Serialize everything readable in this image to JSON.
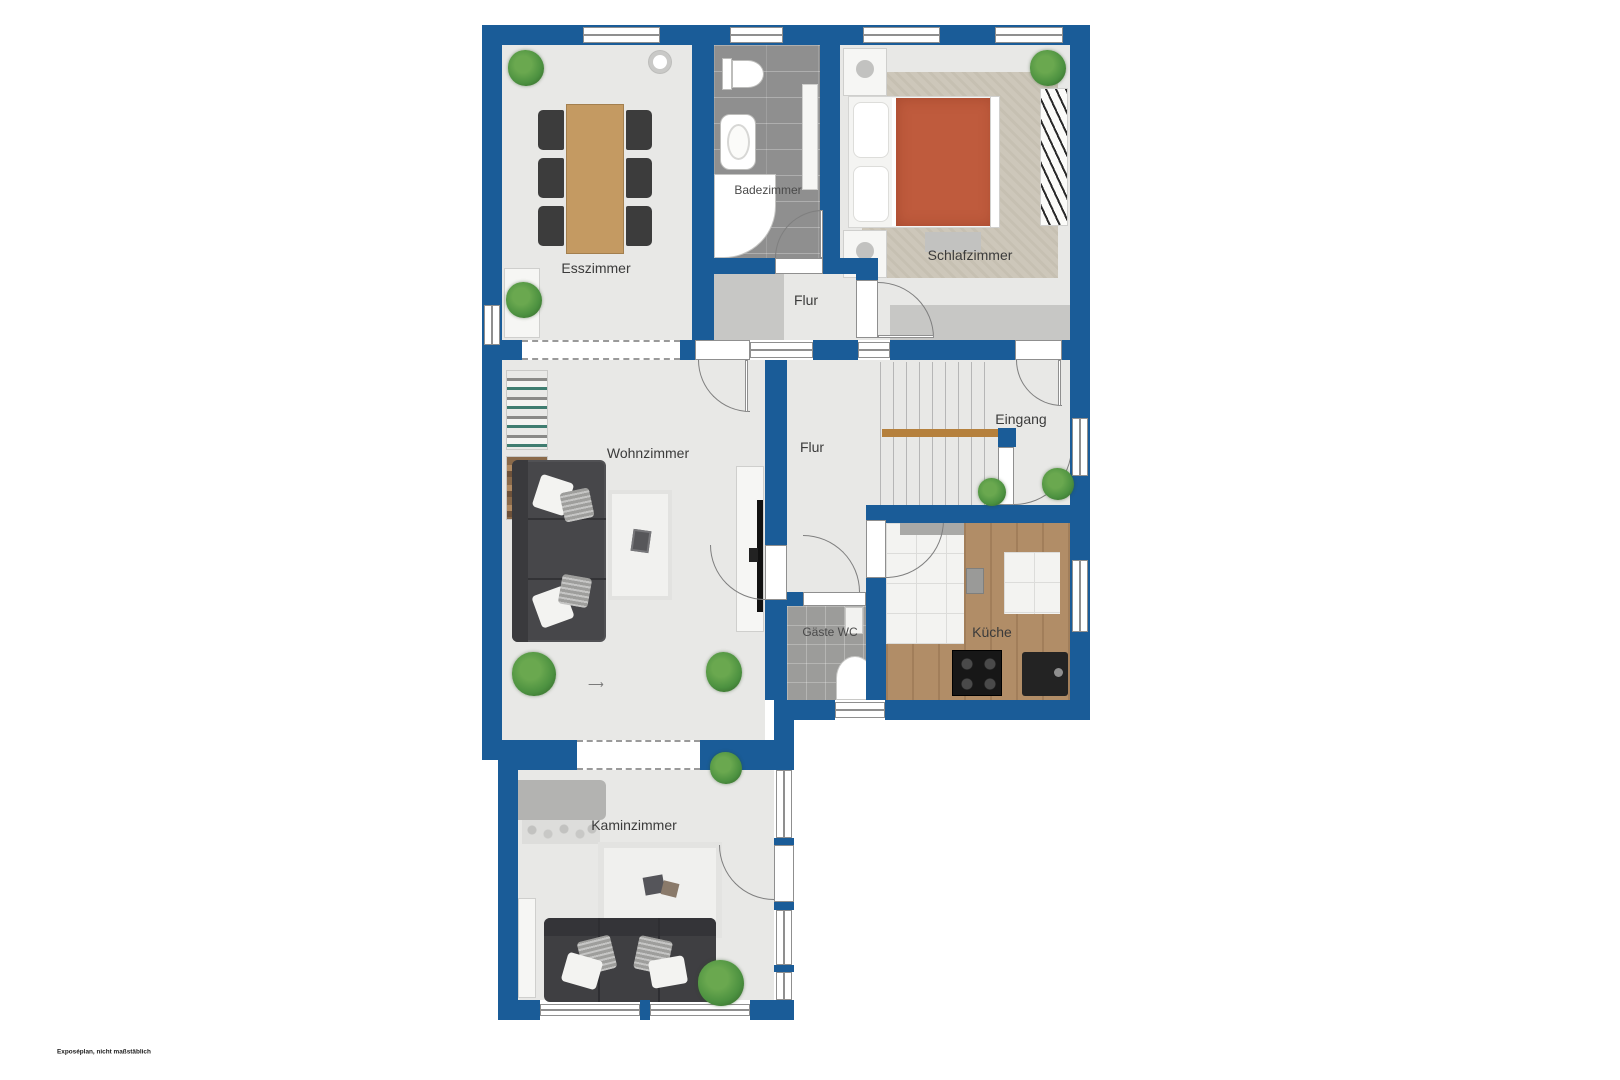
{
  "plan": {
    "disclaimer": "Exposéplan, nicht maßstäblich",
    "rooms": {
      "esszimmer": {
        "label": "Esszimmer"
      },
      "badezimmer": {
        "label": "Badezimmer"
      },
      "schlafzimmer": {
        "label": "Schlafzimmer"
      },
      "flur_oben": {
        "label": "Flur"
      },
      "flur_mitte": {
        "label": "Flur"
      },
      "eingang": {
        "label": "Eingang"
      },
      "wohnzimmer": {
        "label": "Wohnzimmer"
      },
      "gaeste_wc": {
        "label": "Gäste WC"
      },
      "kueche": {
        "label": "Küche"
      },
      "kaminzimmer": {
        "label": "Kaminzimmer"
      }
    },
    "colors": {
      "wall": "#1a5c98",
      "floor": "#e8e8e6",
      "bath_tile": "#8f8f8f",
      "wc_tile": "#9c9c9a",
      "kitchen_tile": "#f3f3f1",
      "counter_wood": "#b18d67",
      "table_wood": "#c49a62",
      "sofa_dark": "#47474a",
      "bed_blanket": "#bf5b3d",
      "bedroom_rug": "#cdc7ba",
      "plant_green": "#4c9140",
      "handrail_wood": "#b5803c",
      "closet_gray": "#c7c7c5",
      "fireplace_gray": "#b3b3b1",
      "label_text": "#3b3b3b"
    }
  }
}
